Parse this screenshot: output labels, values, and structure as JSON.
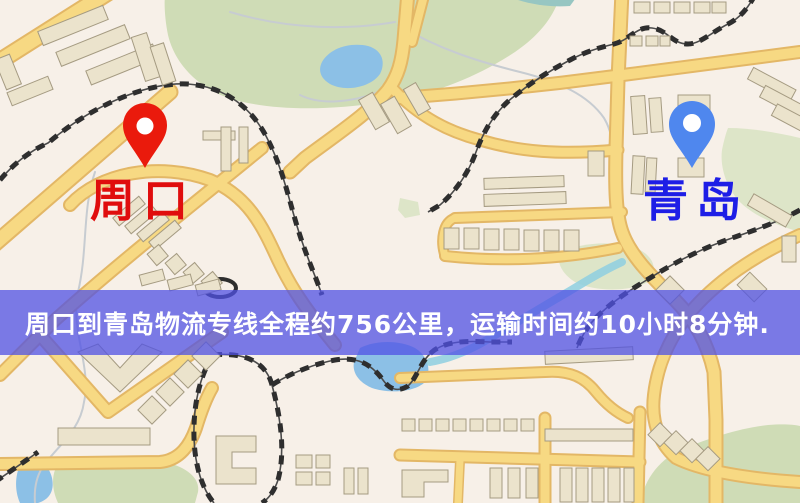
{
  "map": {
    "origin": {
      "label": "周口"
    },
    "destination": {
      "label": "青岛"
    }
  },
  "banner": {
    "text": "周口到青岛物流专线全程约756公里，运输时间约10小时8分钟."
  },
  "colors": {
    "origin_pin": "#ea1a0c",
    "origin_label": "#e00d0d",
    "destination_pin": "#4f87ee",
    "destination_label": "#1e1ee6",
    "banner_bg": "rgba(80,82,228,0.75)",
    "banner_text": "#ffffff",
    "road": "#f7d983",
    "road_casing": "#e3b766",
    "park": "#cfdcb6",
    "water": "#8cc0e6",
    "building": "#ebe3cc",
    "railway": "#2e2e2e",
    "background": "#f7f0e8"
  }
}
